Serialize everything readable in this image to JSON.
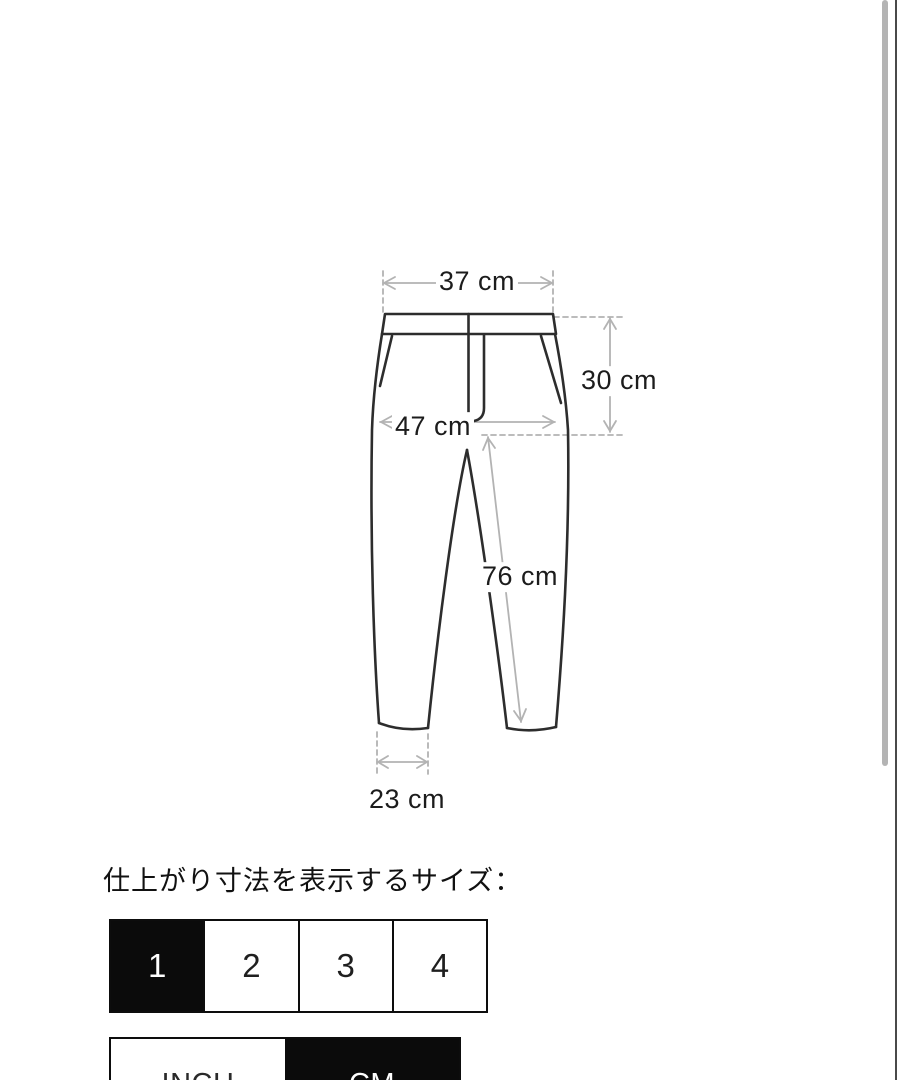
{
  "page": {
    "background": "#ffffff"
  },
  "diagram": {
    "type": "pants-measurement-flat",
    "outline_color": "#2d2d2d",
    "dimension_color": "#b3b3b3",
    "measurements": {
      "waist_width": "37 cm",
      "rise": "30 cm",
      "hip_width": "47 cm",
      "inseam": "76 cm",
      "hem_width": "23 cm"
    }
  },
  "size_section": {
    "caption": "仕上がり寸法を表示するサイズ：",
    "options": [
      "1",
      "2",
      "3",
      "4"
    ],
    "selected_option": "1",
    "selected_bg": "#000000",
    "selected_text_color": "#ffffff"
  },
  "unit_toggle": {
    "options": [
      "INCH",
      "CM"
    ],
    "selected_option": "CM"
  }
}
